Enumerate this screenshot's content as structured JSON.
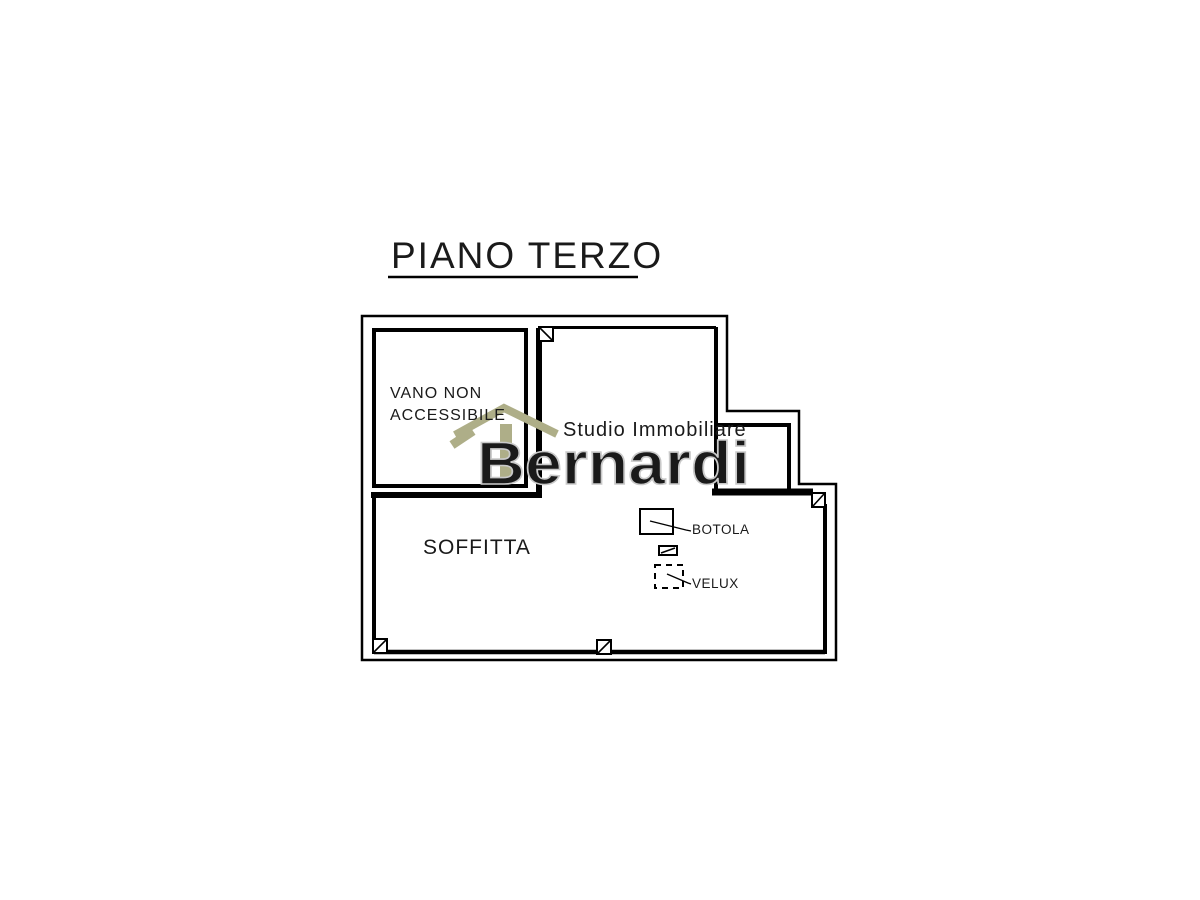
{
  "title": "PIANO TERZO",
  "rooms": {
    "vano_non_accessibile_line1": "VANO NON",
    "vano_non_accessibile_line2": "ACCESSIBILE",
    "soffitta": "SOFFITTA"
  },
  "annotations": {
    "botola": "BOTOLA",
    "velux": "VELUX"
  },
  "watermark": {
    "studio": "Studio Immobiliare",
    "brand": "Bernardi"
  },
  "colors": {
    "wall": "#000000",
    "background": "#ffffff",
    "watermark_accent": "#aeae88",
    "watermark_studio_text": "#b3b3b3",
    "watermark_brand_outline": "#c9c9c9"
  }
}
